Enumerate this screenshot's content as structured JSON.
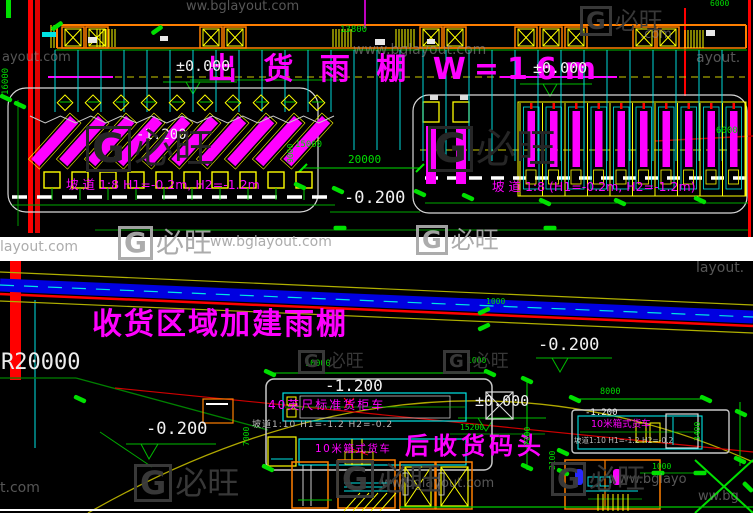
{
  "drawing": {
    "type": "cad-site-plan",
    "app": "autocad-style-plan",
    "panel_count": 2
  },
  "colors": {
    "background": "#000000",
    "gap": "#FFFFFF",
    "annotation": "#FF00FF",
    "dimension": "#00DD00",
    "grid": "#00E5E5",
    "structure": "#FFFF00",
    "wall": "#FF7F00",
    "road_edge": "#FF0000",
    "road": "#0000E0",
    "level_text": "#F0F0F0"
  },
  "top_panel": {
    "title": "出 货 雨 棚 W=16m",
    "ramp_note_left": "坡 道 1:8 H1=-0.2m, H2=-1.2m",
    "ramp_note_right": "坡 道 1:8 (H1=-0.2m, H2=-1.2m)",
    "levels": [
      {
        "name": "level-zero-left",
        "text": "±0.000",
        "x": 176,
        "y": 59,
        "size": 15
      },
      {
        "name": "level-zero-right",
        "text": "±0.000",
        "x": 533,
        "y": 61,
        "size": 15
      },
      {
        "name": "level-minus-1200-docks",
        "text": "-1.200",
        "x": 136,
        "y": 128,
        "size": 14
      },
      {
        "name": "level-minus-0200-yard",
        "text": "-0.200",
        "x": 344,
        "y": 190,
        "size": 17
      }
    ],
    "dims": [
      {
        "name": "dim-13800",
        "text": "13800",
        "x": 340,
        "y": 26,
        "size": 9
      },
      {
        "name": "dim-6000-top",
        "text": "6000",
        "x": 710,
        "y": 0,
        "size": 8
      },
      {
        "name": "dim-16000",
        "text": "16000",
        "x": 2,
        "y": 95,
        "size": 9,
        "rot": true
      },
      {
        "name": "dim-15000",
        "text": "15000",
        "x": 295,
        "y": 141,
        "size": 9
      },
      {
        "name": "dim-9000",
        "text": "9000",
        "x": 287,
        "y": 163,
        "size": 8,
        "rot": true
      },
      {
        "name": "dim-20000",
        "text": "20000",
        "x": 348,
        "y": 154,
        "size": 11
      },
      {
        "name": "dim-6000-right",
        "text": "6000",
        "x": 716,
        "y": 127,
        "size": 9
      }
    ]
  },
  "bottom_panel": {
    "title": "收货区域加建雨棚",
    "dock_label": "后收货码头",
    "radius_label": "R20000",
    "container_truck_label": "40英尺标准货柜车",
    "box_truck_label": "10米箱式货车",
    "box_truck_label_right": "10米箱式货车",
    "ramp_note_center": "坡道1:10 H1=-1.2 H2=-0.2",
    "ramp_note_right": "坡道1:10 H1=-1.2 H2=-0.2",
    "levels": [
      {
        "name": "level-minus-0200-road",
        "text": "-0.200",
        "x": 538,
        "y": 337,
        "size": 17
      },
      {
        "name": "level-minus-1200-center",
        "text": "-1.200",
        "x": 325,
        "y": 378,
        "size": 16
      },
      {
        "name": "level-zero-center",
        "text": "±0.000",
        "x": 475,
        "y": 394,
        "size": 15
      },
      {
        "name": "level-minus-0200-left",
        "text": "-0.200",
        "x": 146,
        "y": 421,
        "size": 17
      },
      {
        "name": "level-minus-1200-right",
        "text": "-1.200",
        "x": 585,
        "y": 409,
        "size": 9
      }
    ],
    "dims": [
      {
        "name": "dim-1000-road",
        "text": "1000",
        "x": 486,
        "y": 298,
        "size": 8
      },
      {
        "name": "dim-1000-mid",
        "text": "1000",
        "x": 467,
        "y": 357,
        "size": 8
      },
      {
        "name": "dim-10000",
        "text": "10000",
        "x": 305,
        "y": 360,
        "size": 8.5
      },
      {
        "name": "dim-7000",
        "text": "7000",
        "x": 243,
        "y": 446,
        "size": 8,
        "rot": true
      },
      {
        "name": "dim-7200",
        "text": "7200",
        "x": 524,
        "y": 446,
        "size": 8,
        "rot": true
      },
      {
        "name": "dim-15200",
        "text": "15200",
        "x": 460,
        "y": 424,
        "size": 8
      },
      {
        "name": "dim-8000",
        "text": "8000",
        "x": 600,
        "y": 388,
        "size": 8.5
      },
      {
        "name": "dim-3400",
        "text": "3400",
        "x": 694,
        "y": 441,
        "size": 8,
        "rot": true
      },
      {
        "name": "dim-2100",
        "text": "2100",
        "x": 549,
        "y": 470,
        "size": 8,
        "rot": true
      },
      {
        "name": "dim-1000-stairs",
        "text": "1000",
        "x": 652,
        "y": 463,
        "size": 8
      }
    ]
  },
  "watermark": {
    "site": "www.bglayout.com",
    "brand": "必旺",
    "items": [
      {
        "type": "text",
        "text": "ww.bglayout.com",
        "x": 186,
        "y": 0,
        "size": 13
      },
      {
        "type": "text",
        "text": "www.bglayout.com",
        "x": 353,
        "y": 43,
        "size": 14
      },
      {
        "type": "text",
        "text": "ayout.com",
        "x": 2,
        "y": 51,
        "size": 13
      },
      {
        "type": "text",
        "text": ".com",
        "x": 640,
        "y": 28,
        "size": 13
      },
      {
        "type": "text",
        "text": "ayout.",
        "x": 696,
        "y": 51,
        "size": 14
      },
      {
        "type": "logo",
        "x": 580,
        "y": 6,
        "size": 24,
        "cls": "wm-dark"
      },
      {
        "type": "logo",
        "x": 86,
        "y": 126,
        "size": 40,
        "cls": "wm-faint"
      },
      {
        "type": "logo",
        "x": 428,
        "y": 126,
        "size": 40,
        "cls": "wm-faint"
      },
      {
        "type": "text",
        "text": "layout.com",
        "x": 0,
        "y": 240,
        "size": 14,
        "cls": "wm-gap"
      },
      {
        "type": "logo",
        "x": 118,
        "y": 226,
        "size": 28,
        "cls": "wm-gap"
      },
      {
        "type": "text",
        "text": "ww.bglayout.com",
        "x": 210,
        "y": 235,
        "size": 14,
        "cls": "wm-gap"
      },
      {
        "type": "logo",
        "x": 416,
        "y": 225,
        "size": 24,
        "cls": "wm-gap"
      },
      {
        "type": "text",
        "text": "layout.",
        "x": 696,
        "y": 261,
        "size": 14
      },
      {
        "type": "logo",
        "x": 298,
        "y": 350,
        "size": 18,
        "cls": "wm-dark"
      },
      {
        "type": "logo",
        "x": 443,
        "y": 350,
        "size": 18,
        "cls": "wm-dark"
      },
      {
        "type": "logo",
        "x": 134,
        "y": 464,
        "size": 32,
        "cls": "wm-dark"
      },
      {
        "type": "text",
        "text": "t.com",
        "x": 0,
        "y": 481,
        "size": 14
      },
      {
        "type": "text",
        "text": "ww.bglayout.com",
        "x": 381,
        "y": 477,
        "size": 13
      },
      {
        "type": "text",
        "text": "www.bglayo",
        "x": 608,
        "y": 473,
        "size": 13
      },
      {
        "type": "text",
        "text": "ww.bg",
        "x": 698,
        "y": 490,
        "size": 13
      },
      {
        "type": "logo",
        "x": 336,
        "y": 460,
        "size": 32,
        "cls": "wm-dark"
      },
      {
        "type": "logo",
        "x": 551,
        "y": 462,
        "size": 28,
        "cls": "wm-dark"
      }
    ]
  }
}
